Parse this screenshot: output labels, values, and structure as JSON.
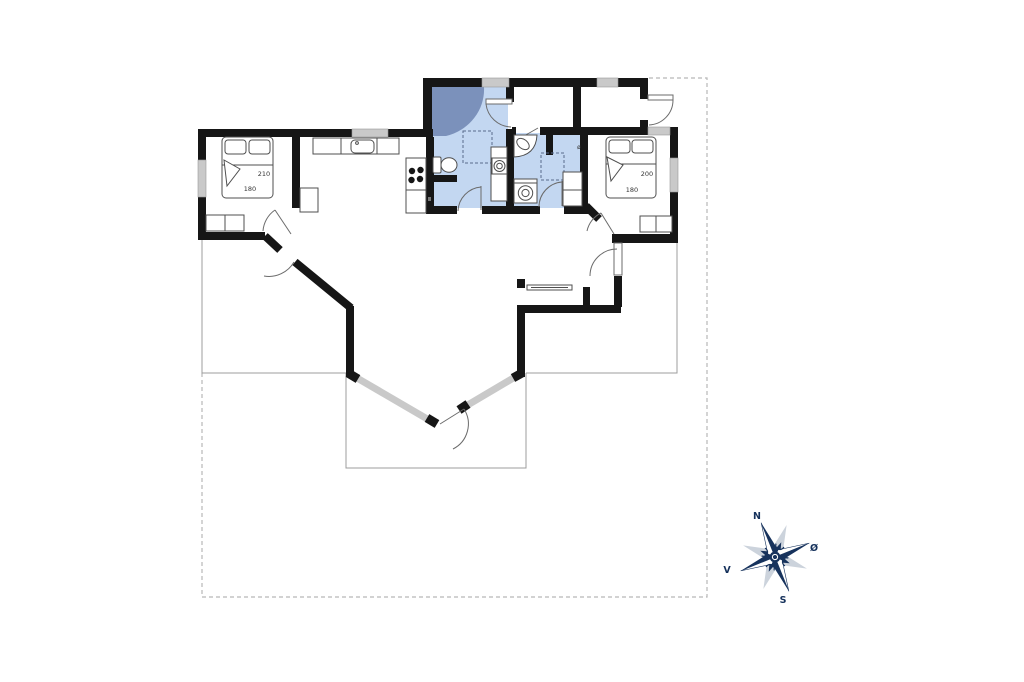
{
  "floorplan": {
    "bedroom_left": {
      "bed_length": "210",
      "bed_width": "180"
    },
    "bedroom_right": {
      "bed_length": "200",
      "bed_width": "180"
    },
    "bathroom_right": {
      "symbol": "ø"
    },
    "compass": {
      "north": "N",
      "east": "Ø",
      "south": "S",
      "west": "V"
    },
    "colors": {
      "wall": "#161616",
      "bathroom_fill": "#c3d7f1",
      "shower_fill": "#7b91bb",
      "window": "#c9c9c9",
      "terrace_line": "#9c9c9c",
      "boundary_dash": "#b8b8b8",
      "compass_navy": "#16325c",
      "compass_shadow": "#ccd3dc"
    }
  }
}
